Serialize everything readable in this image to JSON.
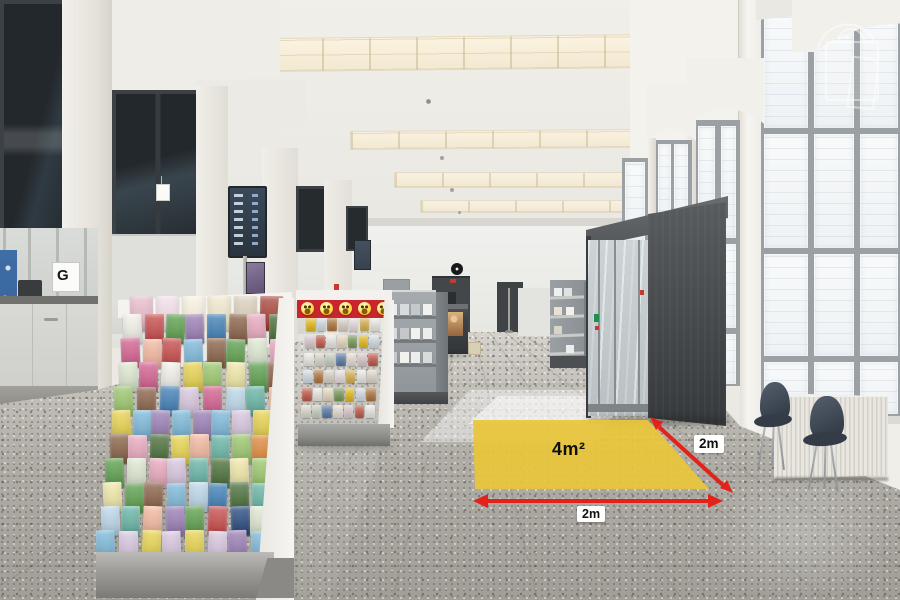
{
  "photo": {
    "annotations": {
      "area_label": "4m²",
      "width_label": "2m",
      "depth_label": "2m",
      "highlight_color": "#e8c63a",
      "arrow_color": "#e32219",
      "label_bg": "#ffffff",
      "label_color": "#111111"
    },
    "signs": {
      "counter_letter": "G"
    },
    "icons": {
      "watermark": "shopping-bag-door-icon",
      "emoji": "smiley-face-emoji",
      "clock": "wall-clock"
    },
    "colors": {
      "wall": "#f0eee8",
      "ceiling": "#efede8",
      "floor": "#b2afa8",
      "window_frame": "#9aa0a3",
      "portal": "#4b4e51",
      "chair": "#3b4350",
      "radiator": "#e9e6df",
      "counter_dark": "#46494c",
      "emoji_banner": "#c8252c",
      "emoji_yellow": "#ffd23e",
      "display_board": "#32404d",
      "rack_base": "#a8a8a4",
      "blue_poster": "#3f6fa6",
      "fire_sign_red": "#c23b2e"
    },
    "palettes": {
      "cards": [
        "#f3f1e9",
        "#9cc86d",
        "#5da04e",
        "#7db9da",
        "#3f7fb6",
        "#27497e",
        "#e9a9bf",
        "#d56190",
        "#e8d44f",
        "#f0e8a8",
        "#67b5a5",
        "#c84b4b",
        "#e08a3c",
        "#9b7fb5",
        "#dfe9d2",
        "#8a6248",
        "#bcd8ea",
        "#4a6f3a",
        "#d9c7e0",
        "#f4b8a0"
      ],
      "top_row": [
        "#e8b7c9",
        "#f2dce6",
        "#f6f0dd",
        "#efe6c8",
        "#d9cdb8",
        "#a33b2e"
      ],
      "mini_cards": [
        "#f0c417",
        "#f6f4ee",
        "#efe9dd",
        "#e8e2d4",
        "#f3e9e9",
        "#dde8ee",
        "#f0e3c8",
        "#e5d2d8",
        "#cfd9c8",
        "#e0b84e",
        "#b5793f",
        "#7a9e5a",
        "#ca5a4a",
        "#5a7eae",
        "#f7f6f2",
        "#e3ddd0"
      ],
      "shelf_items": [
        "#eceded",
        "#d8dadb",
        "#c4c8ca",
        "#f1f1ee"
      ]
    }
  }
}
